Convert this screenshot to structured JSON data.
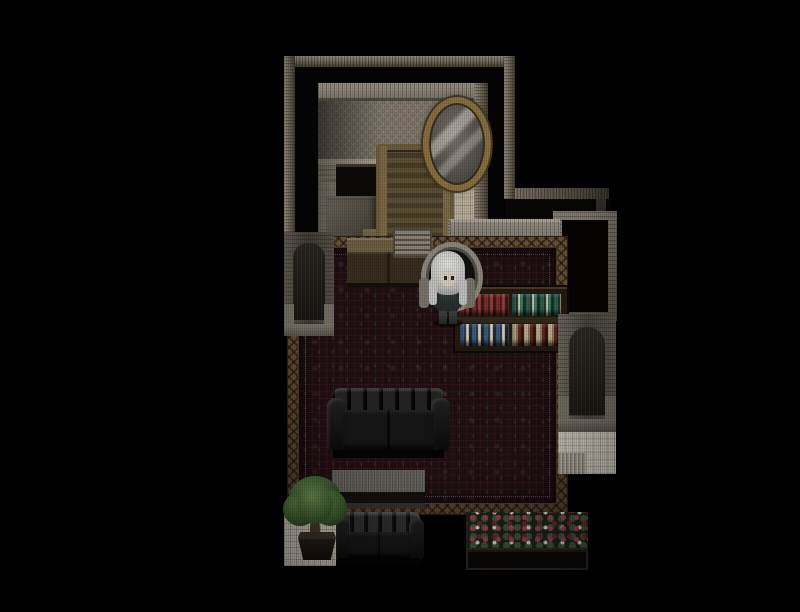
{
  "viewport": {
    "width": 800,
    "height": 612,
    "background": "#000000"
  },
  "game": {
    "label": "Top-down pixel-art RPG interior scene (no HUD text visible)",
    "style": "dark Victorian mansion interior, RPG Maker style map on black letterboxed background",
    "visible_text": []
  },
  "scene": {
    "character": {
      "label": "White-haired character in dark outfit facing the viewer, standing in front of a round-back armchair",
      "hair_color": "#d6d6d4",
      "outfit_color": "#2c3534"
    },
    "objects": {
      "mirror": {
        "label": "Ornate gold oval wall mirror"
      },
      "chair": {
        "label": "Tall wooden slatted chair"
      },
      "desk": {
        "label": "Wooden desk below chair"
      },
      "fireplace": {
        "label": "Dark wall opening / hearth"
      },
      "dresser": {
        "label": "Grey dresser box"
      },
      "radio": {
        "label": "Slatted table radio on sideboard"
      },
      "sideboard": {
        "label": "Wooden sideboard cabinet"
      },
      "armchair": {
        "label": "Round-back armchair behind character"
      },
      "book_stack": {
        "label": "Stacked books on alcove shelf"
      },
      "books_standing": {
        "label": "Standing books on alcove shelf"
      },
      "model_ship": {
        "label": "Model sailing ship with white sails"
      },
      "bookcase": {
        "label": "Dark bookcase with two rows of colored book spines"
      },
      "arch_left": {
        "label": "Arched stone alcove on left wall"
      },
      "arch_right": {
        "label": "Arched stone doorway on right wing"
      },
      "entry_floor": {
        "label": "Light checkered entry floor below right doorway"
      },
      "carpet": {
        "label": "Dark red patterned carpet with ornate gold lattice border"
      },
      "sofa_upper": {
        "label": "Black tufted leather sofa facing down"
      },
      "table": {
        "label": "Long dark table with grey top"
      },
      "sofa_lower": {
        "label": "Black tufted leather sofa at bottom"
      },
      "potted_tree": {
        "label": "Potted tree on white tiles"
      },
      "corner_tiles": {
        "label": "White tiled floor corner"
      },
      "flower_planter": {
        "label": "Dark planter box with red roses and white flowers"
      },
      "top_room": {
        "label": "Upper room with damask wallpaper, wainscot and tiled floor"
      },
      "wall_frame": {
        "label": "Stone-trimmed wall section on right wing"
      }
    },
    "palette": {
      "wall_trim": "#8a8274",
      "wallpaper": "#7d7466",
      "tile_floor": "#b9b09b",
      "carpet_field": "#200f13",
      "carpet_border": "#5b4733",
      "wood": "#5f4f33",
      "sofa_leather": "#121212",
      "foliage": "#3a5c2d",
      "rose_red": "#a04050",
      "stone": "#56524a",
      "background": "#000000"
    }
  }
}
